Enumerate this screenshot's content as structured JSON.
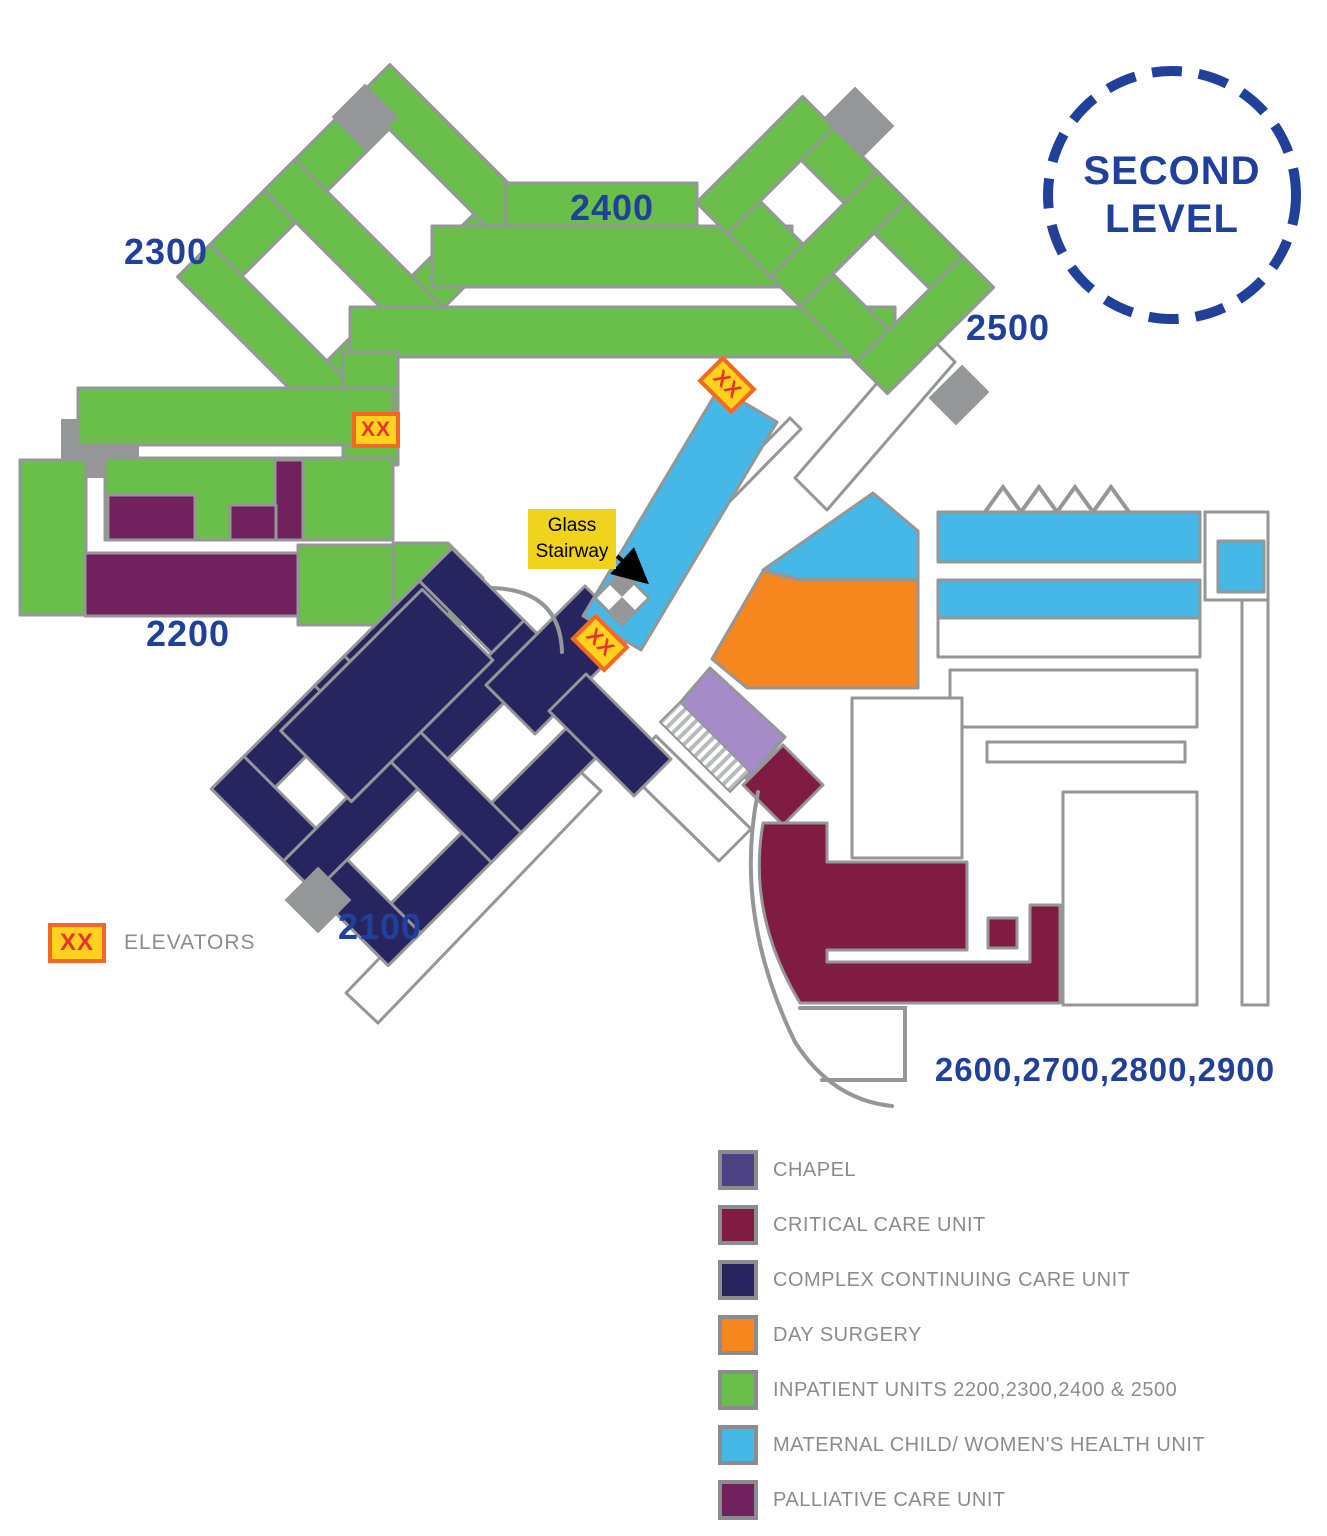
{
  "title": {
    "line1": "SECOND",
    "line2": "LEVEL"
  },
  "map_labels": {
    "wing_2300": "2300",
    "wing_2400": "2400",
    "wing_2500": "2500",
    "wing_2200": "2200",
    "wing_2100": "2100",
    "wing_2600_2900": "2600,2700,2800,2900",
    "glass_stairway_line1": "Glass",
    "glass_stairway_line2": "Stairway",
    "elevator_symbol": "XX"
  },
  "elevators_key": {
    "symbol": "XX",
    "label": "ELEVATORS"
  },
  "legend": {
    "items": [
      {
        "label": "CHAPEL",
        "color": "#4d4384"
      },
      {
        "label": "CRITICAL CARE UNIT",
        "color": "#801b42"
      },
      {
        "label": "COMPLEX CONTINUING CARE UNIT",
        "color": "#272560"
      },
      {
        "label": "DAY SURGERY",
        "color": "#f6871f"
      },
      {
        "label": "INPATIENT UNITS 2200,2300,2400 & 2500",
        "color": "#6abf4a"
      },
      {
        "label": "MATERNAL CHILD/ WOMEN'S HEALTH UNIT",
        "color": "#45b8e8"
      },
      {
        "label": "PALLIATIVE CARE UNIT",
        "color": "#72215f"
      }
    ]
  },
  "colors": {
    "green": "#6abf4a",
    "navy": "#272560",
    "blue": "#45b8e8",
    "orange": "#f6871f",
    "maroon": "#801b42",
    "palliative": "#72215f",
    "chapel_area": "#a58cc8",
    "wall": "#949698",
    "label_blue": "#21409a",
    "legend_text": "#8a8c8e",
    "elevator_fill": "#ffd21e",
    "elevator_border": "#f26824",
    "elevator_text": "#e8332a",
    "stair_bg": "#f0d31c"
  }
}
